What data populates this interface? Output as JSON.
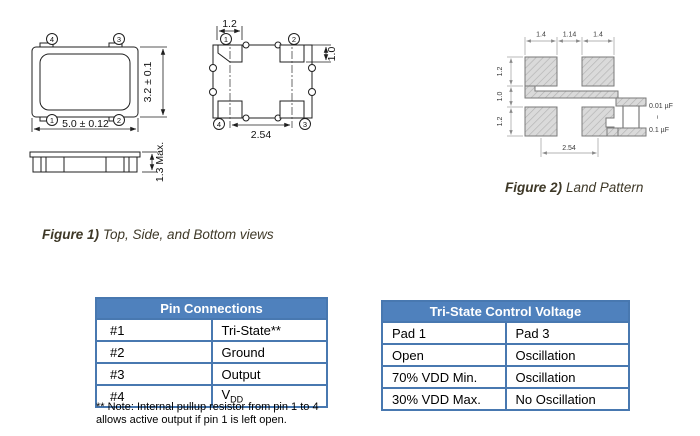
{
  "figure1": {
    "caption_bold": "Figure 1)",
    "caption_text": "Top, Side, and Bottom views",
    "top_view": {
      "pin_tl": "4",
      "pin_tr": "3",
      "pin_bl": "1",
      "pin_br": "2",
      "width_dim": "5.0 ± 0.12",
      "height_dim": "3.2 ± 0.1"
    },
    "side_view": {
      "thickness_dim": "1.3 Max."
    },
    "bottom_view": {
      "pin_tl": "1",
      "pin_tr": "2",
      "pin_bl": "4",
      "pin_br": "3",
      "pad_width_dim": "1.2",
      "pad_height_dim": "1.0",
      "pitch_dim": "2.54"
    }
  },
  "figure2": {
    "caption_bold": "Figure 2)",
    "caption_text": "Land Pattern",
    "dim_pad_w_left": "1.4",
    "dim_gap_w": "1.14",
    "dim_pad_w_right": "1.4",
    "dim_pad_h_top": "1.2",
    "dim_gap_h": "1.0",
    "dim_pad_h_bottom": "1.2",
    "dim_pitch": "2.54",
    "cap_value_min": "0.01 µF",
    "cap_range_tilde": "~",
    "cap_value_max": "0.1 µF"
  },
  "pin_table": {
    "title": "Pin Connections",
    "rows": [
      {
        "pin": "#1",
        "conn": "Tri-State**"
      },
      {
        "pin": "#2",
        "conn": "Ground"
      },
      {
        "pin": "#3",
        "conn": "Output"
      },
      {
        "pin": "#4",
        "conn": "V",
        "conn_sub": "DD"
      }
    ],
    "note_line1": "** Note: Internal pullup resistor from pin 1 to 4",
    "note_line2": "allows active output if pin 1 is left open."
  },
  "tristate_table": {
    "title": "Tri-State Control Voltage",
    "rows": [
      {
        "pad1": "Pad 1",
        "pad3": "Pad 3"
      },
      {
        "pad1": "Open",
        "pad3": "Oscillation"
      },
      {
        "pad1": "70% VDD Min.",
        "pad3": "Oscillation"
      },
      {
        "pad1": "30% VDD Max.",
        "pad3": "No Oscillation"
      }
    ]
  },
  "colors": {
    "table_header_blue": "#4f81bd",
    "table_border_blue": "#4878b0",
    "caption_brown": "#3e3827",
    "pad_fill_gray": "#dadada"
  }
}
